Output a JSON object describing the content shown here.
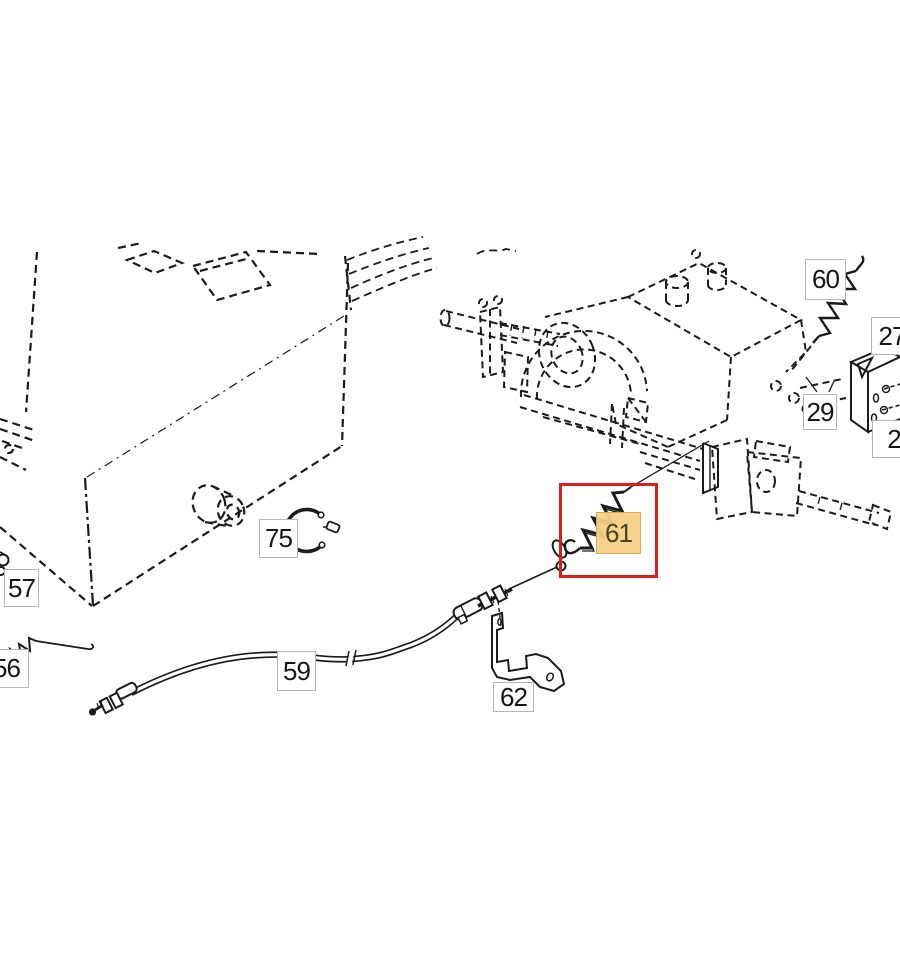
{
  "diagram": {
    "type": "exploded-parts-diagram",
    "background_color": "#ffffff",
    "line_color": "#1b1b1b",
    "highlight": {
      "selected_part_number": "61",
      "box_color": "#dc1f16",
      "label_background": "#f7d087"
    },
    "labels": [
      {
        "number": "57"
      },
      {
        "number": "56"
      },
      {
        "number": "75"
      },
      {
        "number": "59"
      },
      {
        "number": "62"
      },
      {
        "number": "61",
        "highlighted": true
      },
      {
        "number": "60"
      },
      {
        "number": "29"
      },
      {
        "number": "27"
      },
      {
        "number": "2"
      }
    ],
    "components": [
      "chassis-outline",
      "vent-slots",
      "muffler-cylinder",
      "transmission-assembly",
      "left-axle-shaft",
      "brake-drum-arcs",
      "rear-axle-shaft",
      "tension-spring-60",
      "tension-spring-61",
      "tension-spring-56",
      "snap-ring-75",
      "control-cable-59",
      "cable-adjuster",
      "mounting-bracket-62",
      "mounting-bracket-27",
      "highlight-box"
    ]
  }
}
